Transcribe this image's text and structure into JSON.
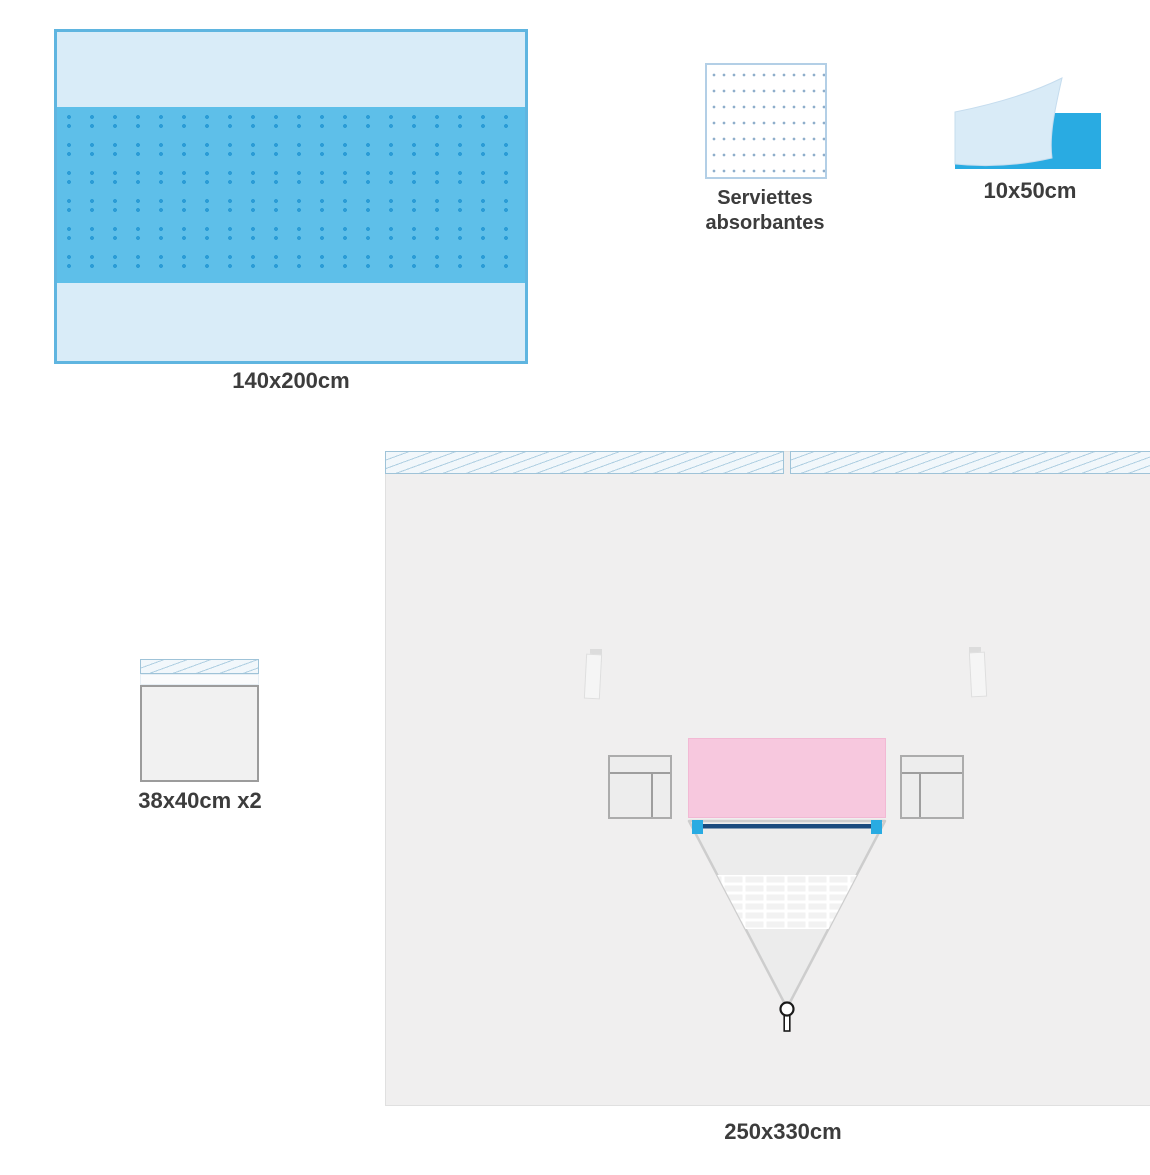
{
  "labels": {
    "drape140": "140x200cm",
    "towels": "Serviettes\nabsorbantes",
    "tape": "10x50cm",
    "smallDrape": "38x40cm x2",
    "bigDrape": "250x330cm"
  },
  "colors": {
    "canvas-bg": "#ffffff",
    "drape-light": "#d9ecf8",
    "drape-border": "#5fb5e0",
    "band-blue": "#5ebfe9",
    "band-dot": "#2b9cd6",
    "towel-border": "#b3cfe6",
    "towel-dot": "#8faecb",
    "tape-cyan": "#29abe2",
    "tape-sheet": "#d9ebf7",
    "tape-sheet-edge": "#c5dcee",
    "hatch-bg": "#f1f7fb",
    "hatch-line": "#afcfe2",
    "hatch-border": "#9fc3d8",
    "panel-gray": "#f0efef",
    "panel-border": "#e0e0e0",
    "square-gray": "#f1f1f1",
    "square-border": "#9c9c9c",
    "pink": "#f7c8de",
    "pink-border": "#f2b9d4",
    "pouch-fill": "#ededed",
    "pouch-border": "#acacac",
    "pouch-line": "#9e9e9e",
    "triangle-fill": "#ececec",
    "triangle-border": "#cdcdcd",
    "mesh-line": "#ffffff",
    "rod-navy": "#1a4b7e",
    "rod-end-cyan": "#29abe2",
    "flap-fill": "#f5f5f5",
    "flap-border": "#dedede",
    "flap-tab": "#dcdcdc",
    "port-stroke": "#1a1a1a",
    "label-text": "#3c3c3c"
  }
}
